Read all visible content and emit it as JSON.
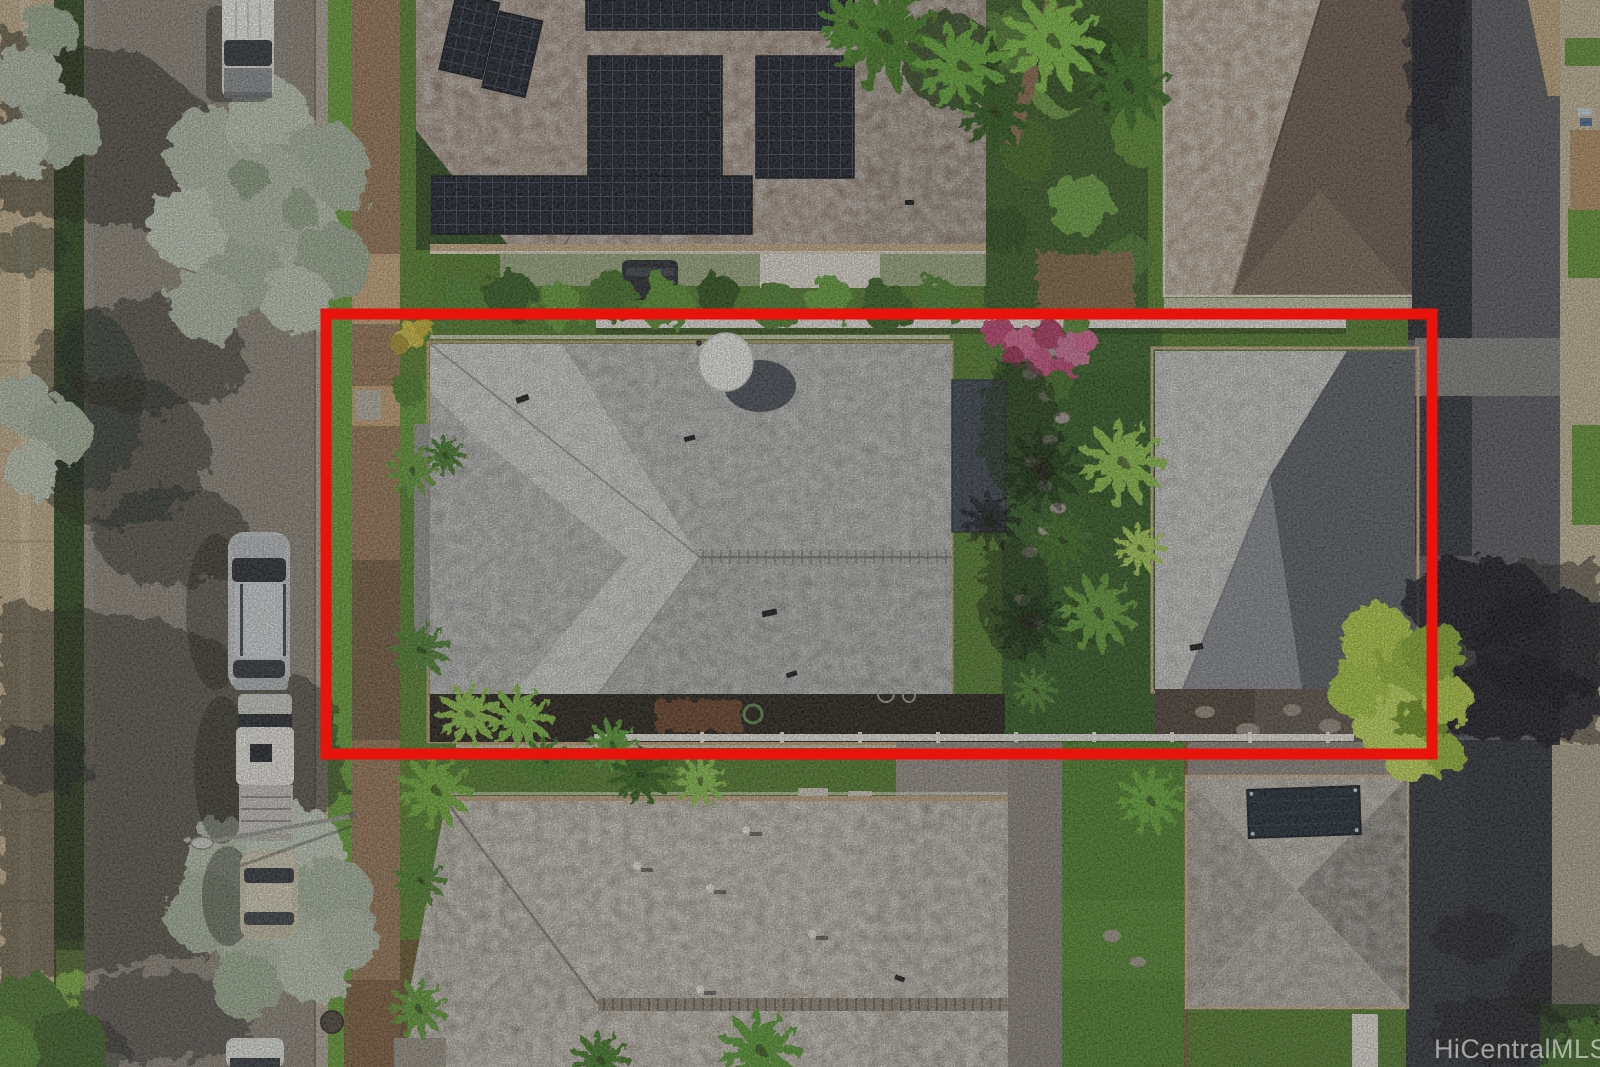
{
  "watermark": {
    "text": "HiCentralMLS"
  },
  "annotation": {
    "type": "property-boundary-rectangle",
    "color": "#e8130b",
    "stroke_px": 11
  },
  "palette": {
    "boundary": "#e8130b",
    "watermark_color": "rgba(255,255,255,0.55)",
    "asphalt_sunlit": "#8d8679",
    "asphalt_right": "#56575b",
    "asphalt_dark_strip": "#23262c",
    "sidewalk_dirt": "#bd9468",
    "sidewalk_concrete": "#c6b998",
    "wall_tan": "#c7b28c",
    "grass_bright": "#6fa436",
    "grass_mid": "#4f7a26",
    "lawn_dark": "#2e571d",
    "roof_subject_base": "#9b9b99",
    "roof_subject_light": "#c4c4bf",
    "roof_rear_light": "#b3b3b0",
    "roof_rear_dark": "#575b61",
    "roof_solar_brown": "#8e7867",
    "roof_nb_light": "#a08a72",
    "roof_nb_dark": "#6a584a",
    "roof_bottom_tan": "#a29a8b",
    "lanai_roof": "#3a414d",
    "solar_panel": "#151a23",
    "fence_white": "#eceae2",
    "foliage_bright": "#7cba3c",
    "foliage_dark": "#2c501a",
    "olive_tree": "#b9c2ac"
  }
}
